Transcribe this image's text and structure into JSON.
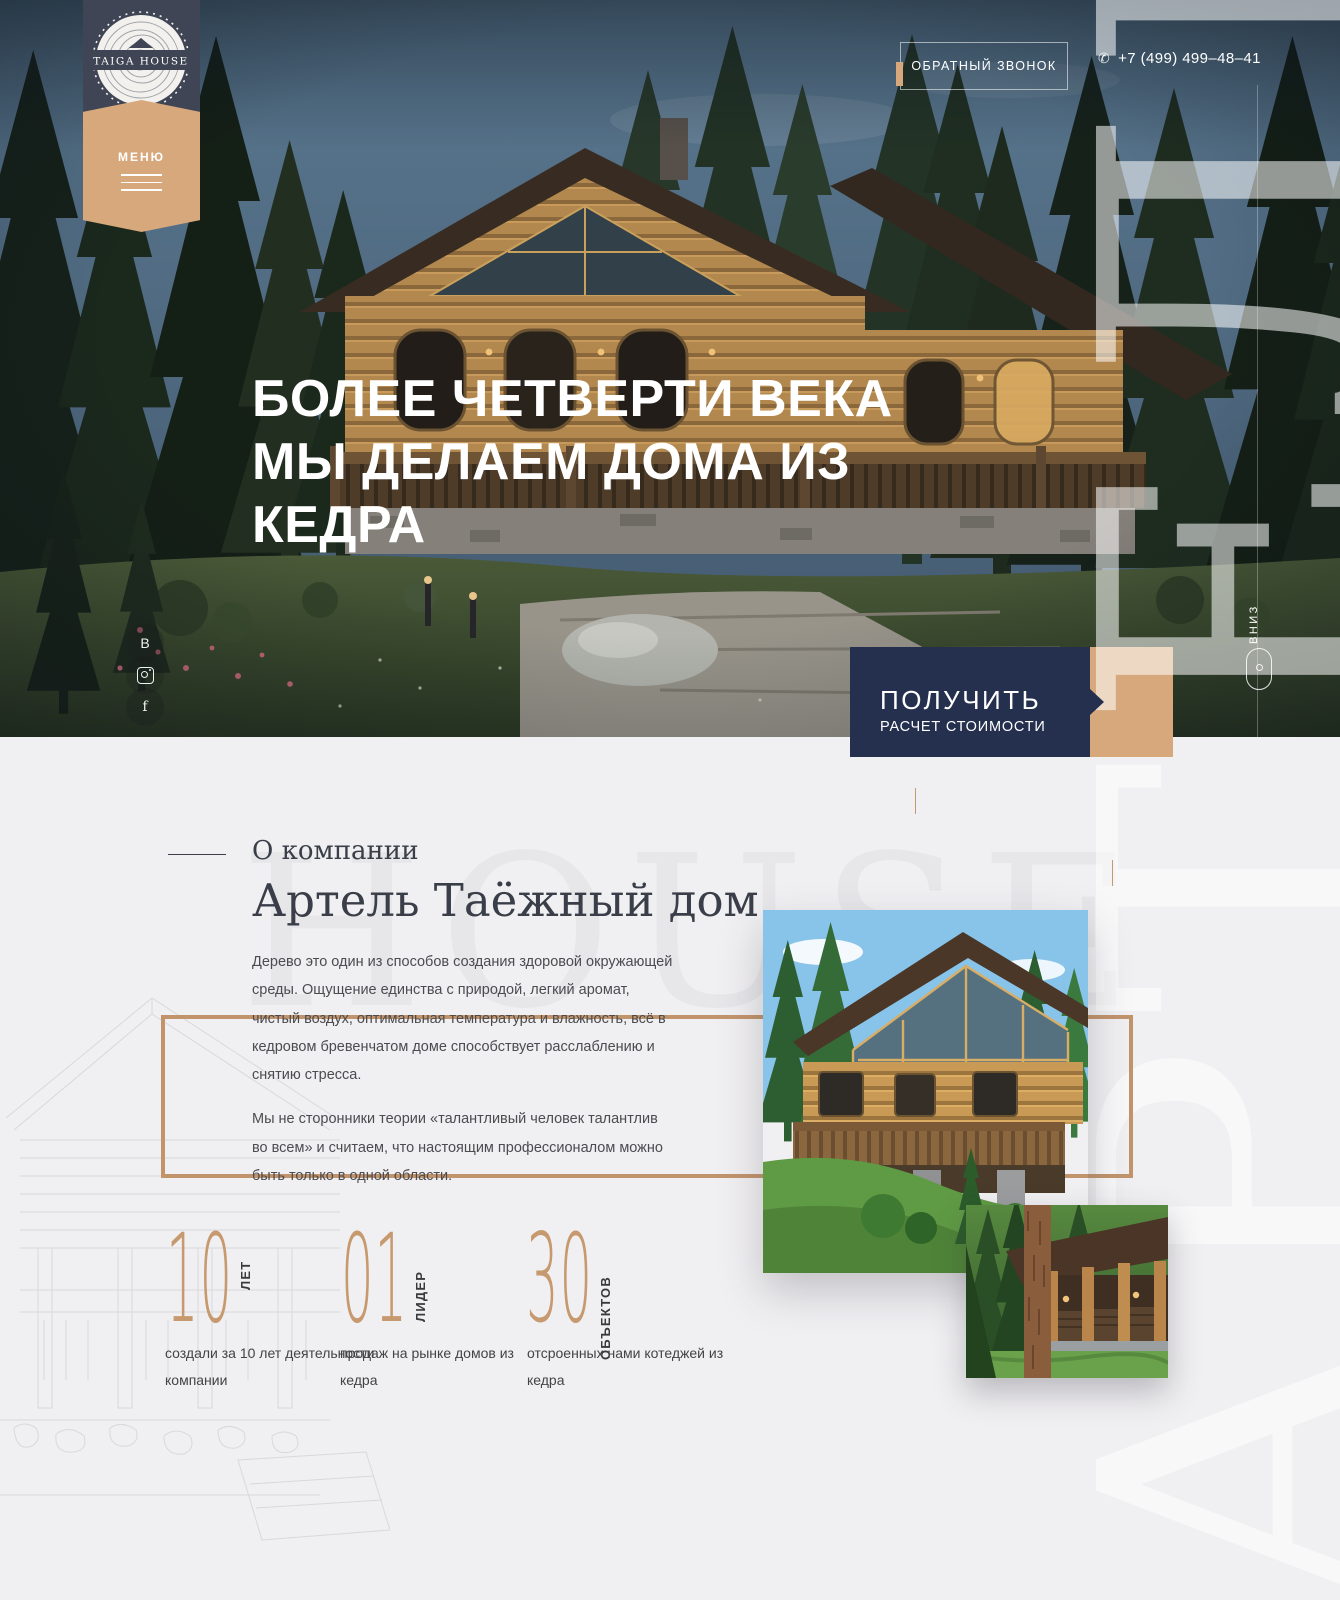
{
  "header": {
    "logo_text": "TAIGA HOUSE",
    "menu_label": "МЕНЮ",
    "callback_label": "ОБРАТНЫЙ ЗВОНОК",
    "phone": "+7 (499) 499–48–41"
  },
  "hero": {
    "title_lines": [
      "БОЛЕЕ ЧЕТВЕРТИ ВЕКА",
      "МЫ ДЕЛАЕМ ДОМА ИЗ",
      "КЕДРА"
    ],
    "cta_line1": "ПОЛУЧИТЬ",
    "cta_line2": "РАСЧЕТ СТОИМОСТИ",
    "scroll_label": "ВНИЗ",
    "social": [
      {
        "name": "vk",
        "glyph": "В"
      },
      {
        "name": "instagram",
        "glyph": ""
      },
      {
        "name": "facebook",
        "glyph": "f"
      }
    ]
  },
  "about": {
    "eyebrow": "О компании",
    "heading": "Артель Таёжный дом",
    "watermark_horizontal": "HOUSE",
    "watermark_vertical": "АРТЕЛЬ",
    "paragraphs": [
      "Дерево это один из способов создания здоровой окружающей среды. Ощущение единства с природой, легкий аромат, чистый воздух, оптимальная температура и влажность, всё в кедровом бревенчатом доме способствует расслаблению и снятию стресса.",
      "Мы не сторонники теории «талантливый человек талантлив во всем» и считаем, что настоящим профессионалом можно быть только в одной области."
    ],
    "stats": [
      {
        "value": "10",
        "unit": "ЛЕТ",
        "caption": "создали за 10 лет деятельности компании"
      },
      {
        "value": "01",
        "unit": "ЛИДЕР",
        "caption": "продаж на рынке домов из кедра"
      },
      {
        "value": "30",
        "unit": "ОБЪЕКТОВ",
        "caption": "отсроенных нами котеджей из кедра"
      }
    ]
  },
  "colors": {
    "navy": "#25304f",
    "badge_navy": "#3f4554",
    "tan": "#d7a87c",
    "frame_copper": "#c1946c",
    "stat_number": "#c7996e",
    "background": "#f0eff1"
  }
}
